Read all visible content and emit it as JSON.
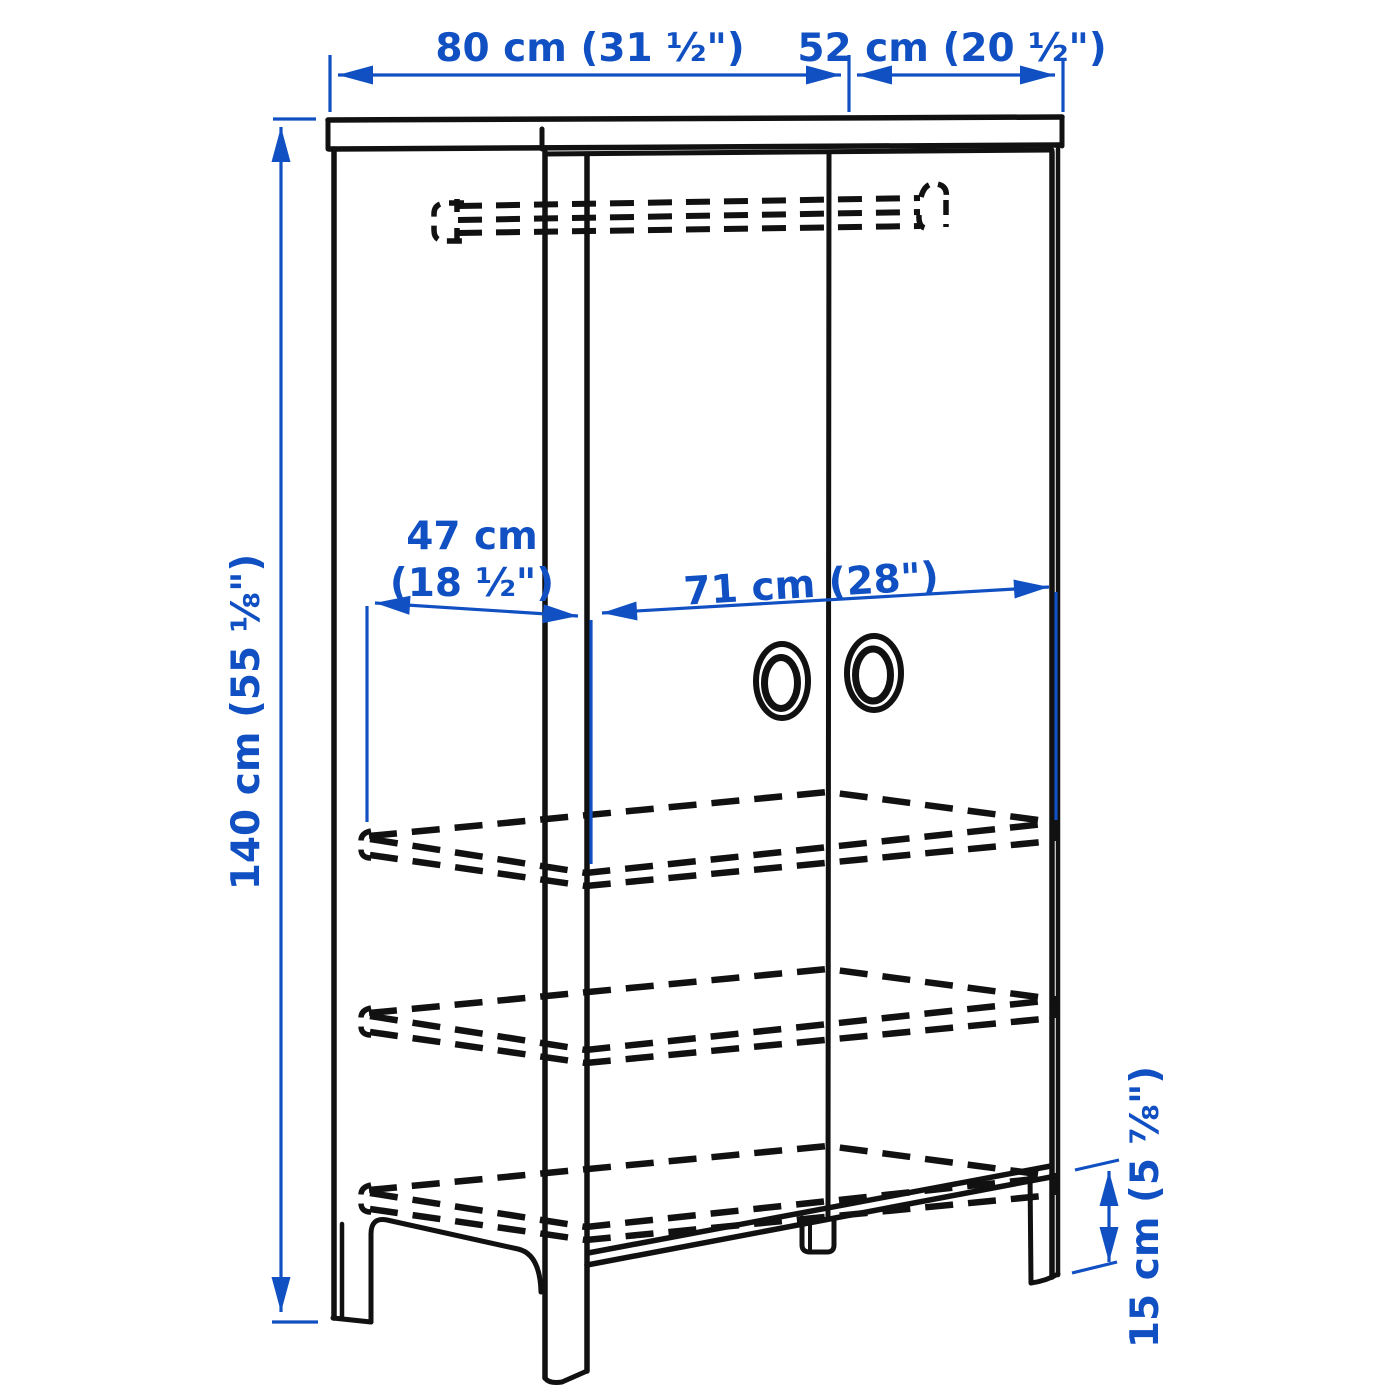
{
  "diagram": {
    "title": "wardrobe-dimension-diagram",
    "colors": {
      "dimension_blue": "#1150c2",
      "outline_black": "#111111",
      "background": "#ffffff"
    },
    "dimensions": {
      "overall_width": "80 cm (31 ½\")",
      "overall_depth": "52 cm (20 ½\")",
      "overall_height": "140 cm (55 ⅛\")",
      "interior_depth_line1": "47 cm",
      "interior_depth_line2": "(18 ½\")",
      "interior_width": "71 cm (28\")",
      "leg_height": "15 cm (5 ⅞\")"
    }
  }
}
